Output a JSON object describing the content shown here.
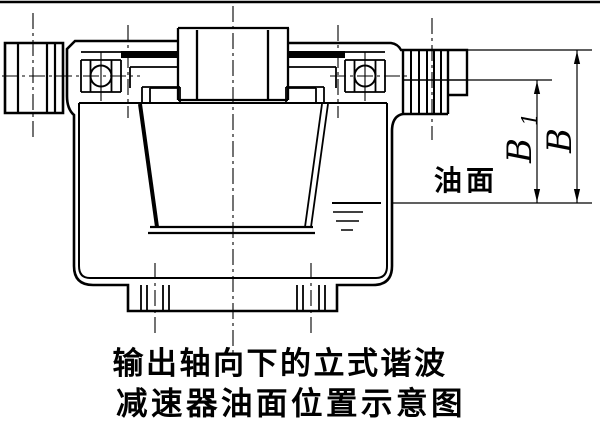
{
  "figure": {
    "oil_surface_label": "油面",
    "dimension_b1": {
      "main": "B",
      "subscript": "1"
    },
    "dimension_b": "B",
    "caption_line1": "输出轴向下的立式谐波",
    "caption_line2": "减速器油面位置示意图"
  },
  "style": {
    "line_color": "#000000",
    "background": "#ffffff"
  }
}
